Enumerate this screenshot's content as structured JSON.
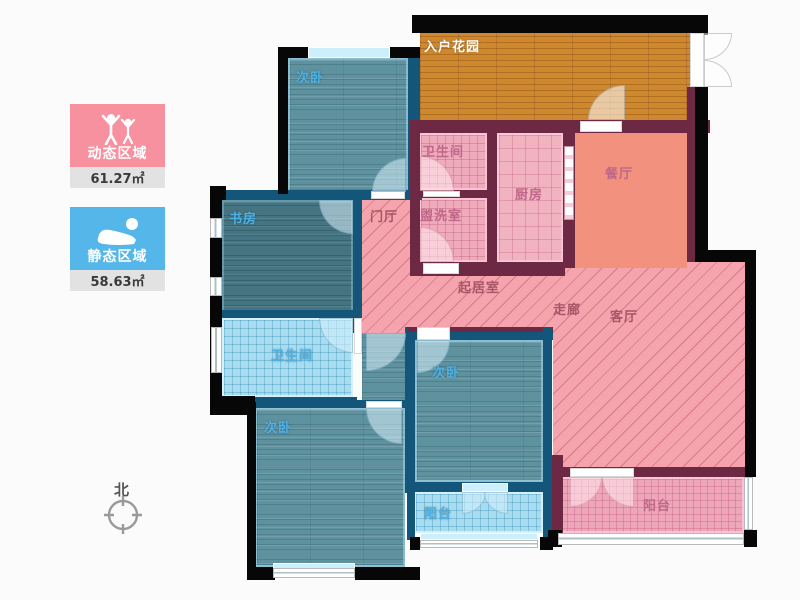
{
  "legend": {
    "dynamic": {
      "label": "动态区域",
      "area": "61.27㎡",
      "color": "#f7909f",
      "icon": "standing-people-icon"
    },
    "static": {
      "label": "静态区域",
      "area": "58.63㎡",
      "color": "#55b6e9",
      "icon": "sleeping-person-icon"
    }
  },
  "compass": {
    "north_label": "北"
  },
  "rooms": {
    "entry_garden": {
      "label": "入户花园"
    },
    "bedroom_top_left": {
      "label": "次卧"
    },
    "bathroom_top": {
      "label": "卫生间"
    },
    "washroom": {
      "label": "盥洗室"
    },
    "kitchen": {
      "label": "厨房"
    },
    "dining_room": {
      "label": "餐厅"
    },
    "study": {
      "label": "书房"
    },
    "foyer": {
      "label": "门厅"
    },
    "sitting_room": {
      "label": "起居室"
    },
    "corridor": {
      "label": "走廊"
    },
    "living_room": {
      "label": "客厅"
    },
    "bathroom_left": {
      "label": "卫生间"
    },
    "bedroom_bottom_leftد": {
      "label": ""
    },
    "bedroom_bottom_left": {
      "label": "次卧"
    },
    "bedroom_middle": {
      "label": "次卧"
    },
    "balcony_blue": {
      "label": "阳台"
    },
    "balcony_pink": {
      "label": "阳台"
    }
  },
  "palette": {
    "wall_blue": "#14567a",
    "wall_maroon": "#6d2944",
    "wall_black": "#070707",
    "hatch_fill": "#f5a3ad",
    "wood_teal": "#5f929f",
    "wood_orange": "#d0882f",
    "tile_blue": "#a8ddf1",
    "tile_pink": "#efaabc",
    "dining_fill": "#f2917e"
  }
}
